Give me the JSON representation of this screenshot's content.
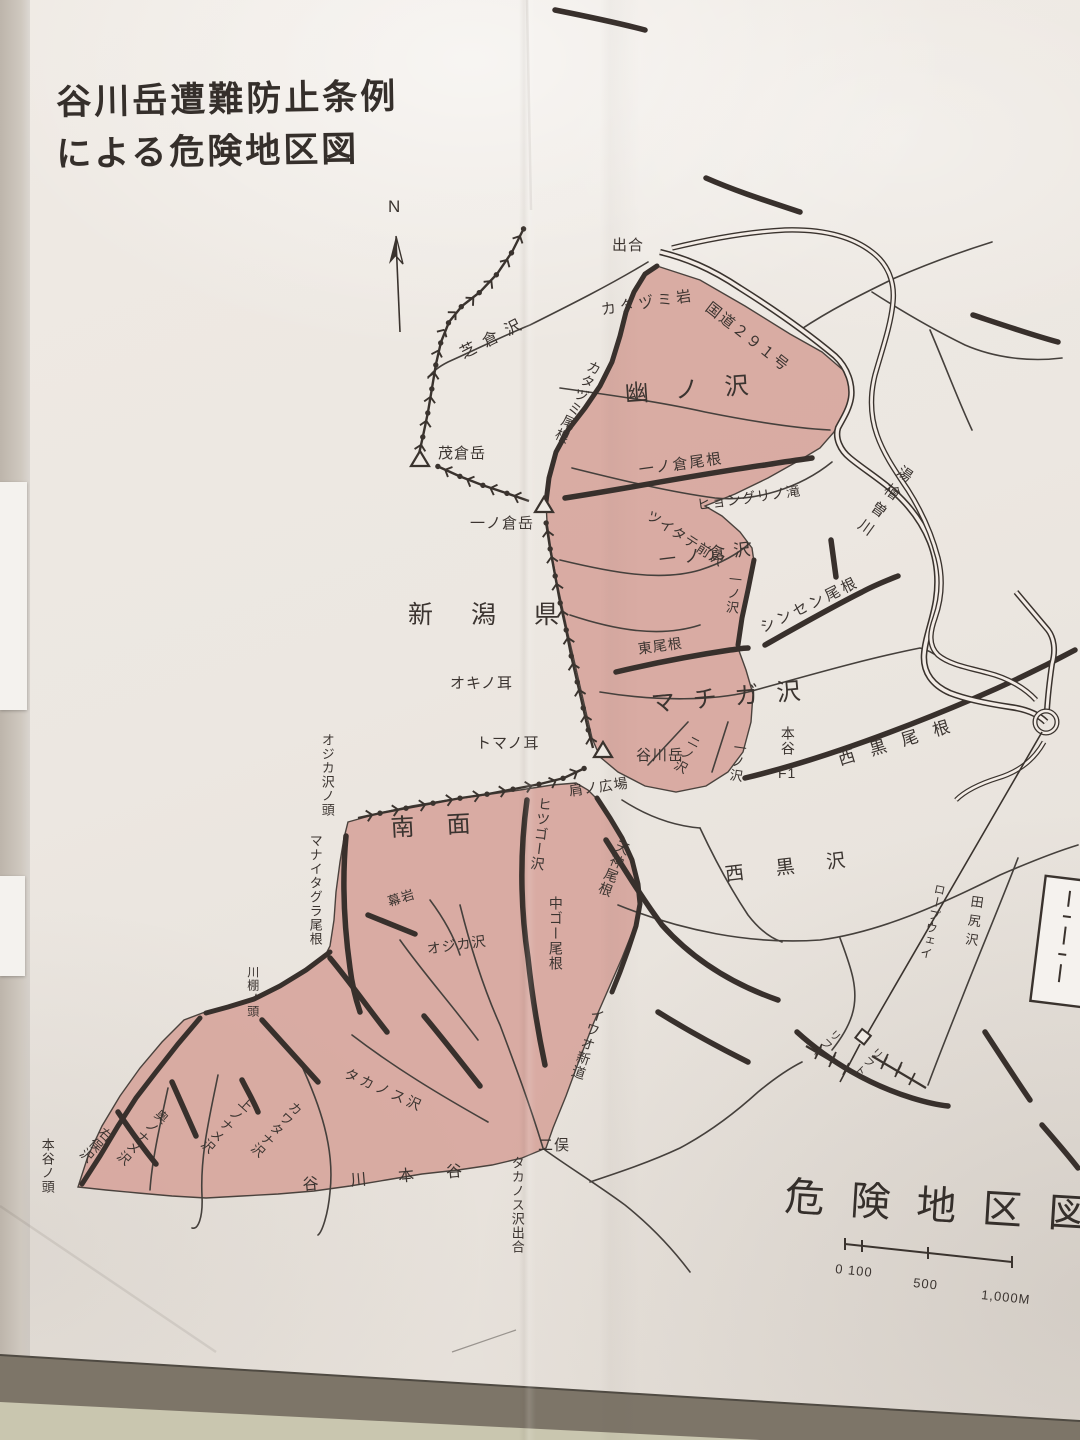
{
  "page_title": {
    "line1": "谷川岳遭難防止条例",
    "line2": "による危険地区図"
  },
  "compass_n": "N",
  "region_title": "危険地区図",
  "prefecture_label": "新潟県",
  "scale_bar": {
    "tick_left": "0 100",
    "tick_mid": "500",
    "tick_right": "1,000M"
  },
  "peaks": {
    "shigekura_dake": "茂倉岳",
    "ichinokura_dake": "一ノ倉岳",
    "tanigawa_dake": "谷川岳"
  },
  "labels": {
    "deai": "出合",
    "katazumi_iwa": "カタヅミ岩",
    "route291": "国道２９１号",
    "shibakura_sawa": "芝倉沢",
    "katazumi_one": "カタヅミ尾根",
    "yuno_sawa": "幽ノ沢",
    "ichinokura_one": "一ノ倉尾根",
    "hyonguri_falls": "ヒョングリノ滝",
    "tsuitate_mae_sawa": "ツイタテ前沢",
    "ichinokura_sawa": "一ノ倉沢",
    "ichino_sawa_upper": "一ノ沢",
    "shinsen_one": "シンセン尾根",
    "higashi_one": "東尾根",
    "okino_mimi": "オキノ耳",
    "machiga_sawa": "マチガ沢",
    "nino_sawa": "ニノ沢",
    "ichino_sawa_machiga": "一ノ沢",
    "hontani": "本谷",
    "f1": "F1",
    "nishikuro_one": "西黒尾根",
    "tomano_mimi": "トマノ耳",
    "katano_hiroba": "肩ノ広場",
    "nanmen": "南面",
    "ojikasawa_no_kashira": "オジカ沢ノ頭",
    "manaitagura_one": "マナイタグラ尾根",
    "hitsugo_sawa": "ヒツゴー沢",
    "nakago_one": "中ゴー尾根",
    "tenjin_one": "天神尾根",
    "nishikuro_sawa": "西黒沢",
    "ropeway": "ロープウェイ",
    "tajiri_sawa": "田尻沢",
    "maku_iwa": "幕岩",
    "ojika_sawa": "オジカ沢",
    "kawadana_no_kashira": "川棚ノ頭",
    "iwao_shindo": "イワオ新道",
    "takanosu_sawa": "タカノス沢",
    "kawatana_sawa": "カワタナ沢",
    "kaminoname_sawa": "上ノナメ沢",
    "okunoname_sawa": "奥ノナメ沢",
    "migimata_sawa": "右俣沢",
    "hontani_no_kashira": "本谷ノ頭",
    "futamata": "二俣",
    "takanosu_sawa_deai": "タカノス沢出合",
    "tanigawa_hontani": "谷川本谷",
    "yubiso_gawa": "湯檜曽川",
    "lift_1": "リフト",
    "lift_2": "リフト"
  },
  "colors": {
    "danger_zone": "#d7a69d",
    "map_line": "#3a332e",
    "text": "#3b3430"
  }
}
